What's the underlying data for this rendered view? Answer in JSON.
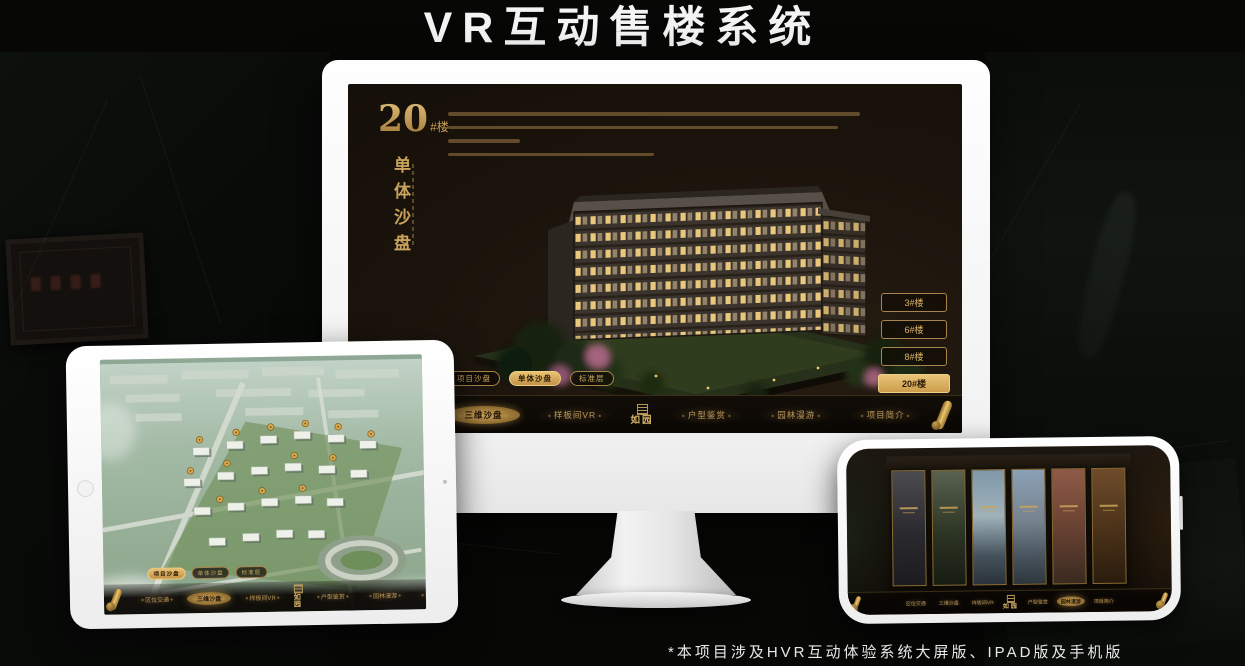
{
  "page": {
    "title": "VR互动售楼系统",
    "footnote": "*本项目涉及HVR互动体验系统大屏版、IPAD版及手机版"
  },
  "brand": {
    "logo_text": "如园",
    "accent_gold": "#cfa65f"
  },
  "monitor": {
    "headline_number": "20",
    "headline_suffix": "#楼",
    "headline_vertical": "单体沙盘",
    "floor_buttons": [
      {
        "label": "3#楼",
        "selected": false
      },
      {
        "label": "6#楼",
        "selected": false
      },
      {
        "label": "8#楼",
        "selected": false
      },
      {
        "label": "20#楼",
        "selected": true
      }
    ],
    "view_tabs": [
      {
        "label": "项目沙盘",
        "selected": false
      },
      {
        "label": "单体沙盘",
        "selected": true
      },
      {
        "label": "标准层",
        "selected": false
      }
    ],
    "nav_items": [
      {
        "label": "区位交通",
        "selected": false
      },
      {
        "label": "三维沙盘",
        "selected": true
      },
      {
        "label": "样板间VR",
        "selected": false
      },
      {
        "label": "户型鉴赏",
        "selected": false
      },
      {
        "label": "园林漫游",
        "selected": false
      },
      {
        "label": "项目简介",
        "selected": false
      }
    ]
  },
  "tablet": {
    "view_tabs": [
      {
        "label": "项目沙盘",
        "selected": true
      },
      {
        "label": "单体沙盘",
        "selected": false
      },
      {
        "label": "标准层",
        "selected": false
      }
    ],
    "nav_items": [
      {
        "label": "区位交通",
        "selected": false
      },
      {
        "label": "三维沙盘",
        "selected": true
      },
      {
        "label": "样板间VR",
        "selected": false
      },
      {
        "label": "户型鉴赏",
        "selected": false
      },
      {
        "label": "园林漫游",
        "selected": false
      },
      {
        "label": "项目简介",
        "selected": false
      }
    ]
  },
  "phone": {
    "nav_items": [
      {
        "label": "区位交通",
        "selected": false
      },
      {
        "label": "三维沙盘",
        "selected": false
      },
      {
        "label": "样板间VR",
        "selected": false
      },
      {
        "label": "户型鉴赏",
        "selected": false
      },
      {
        "label": "园林漫游",
        "selected": true
      },
      {
        "label": "项目简介",
        "selected": false
      }
    ]
  }
}
